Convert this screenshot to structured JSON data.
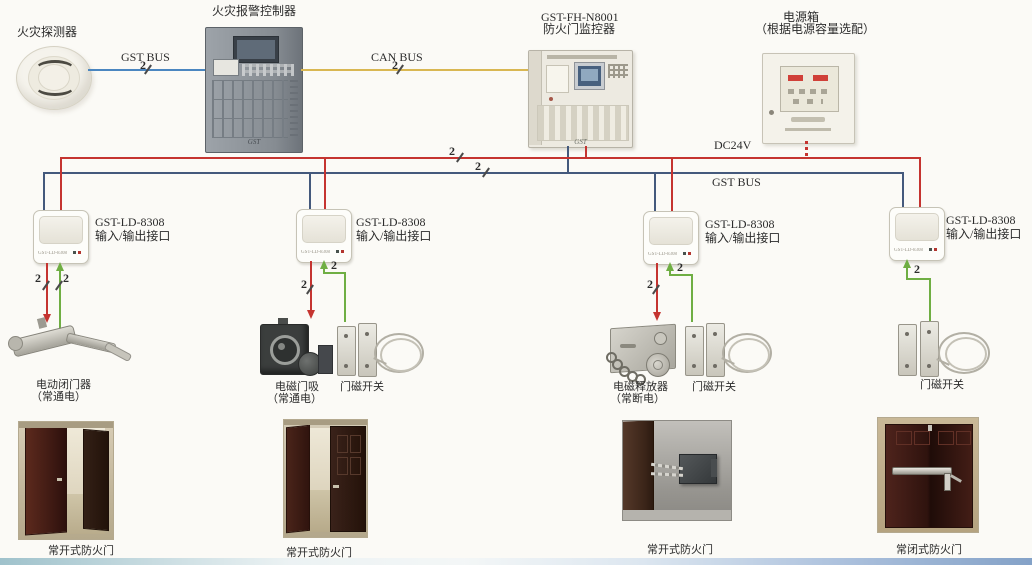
{
  "detector": {
    "label": "火灾探测器"
  },
  "controller": {
    "label": "火灾报警控制器",
    "logo": "GST"
  },
  "monitor": {
    "model": "GST-FH-N8001",
    "label": "防火门监控器",
    "logo": "GST"
  },
  "power_box": {
    "label": "电源箱",
    "note": "（根据电源容量选配）"
  },
  "wires": {
    "gst_bus_top": {
      "label": "GST BUS",
      "count": "2"
    },
    "can_bus": {
      "label": "CAN BUS",
      "count": "2"
    },
    "dc24v": {
      "label": "DC24V",
      "count": "2"
    },
    "gst_bus_main": {
      "label": "GST BUS",
      "count": "2"
    }
  },
  "modules": [
    {
      "model": "GST-LD-8308",
      "label": "输入/输出接口",
      "out_count": "2",
      "in_count": "2"
    },
    {
      "model": "GST-LD-8308",
      "label": "输入/输出接口",
      "out_count": "2",
      "in_count": "2"
    },
    {
      "model": "GST-LD-8308",
      "label": "输入/输出接口",
      "out_count": "2",
      "in_count": "2"
    },
    {
      "model": "GST-LD-8308",
      "label": "输入/输出接口",
      "in_count": "2"
    }
  ],
  "field_devices": {
    "door_closer": {
      "name": "电动闭门器",
      "note": "（常通电）"
    },
    "door_holder": {
      "name": "电磁门吸",
      "note": "（常通电）"
    },
    "door_switch1": {
      "name": "门磁开关"
    },
    "releaser": {
      "name": "电磁释放器",
      "note": "（常断电）"
    },
    "door_switch2": {
      "name": "门磁开关"
    },
    "door_switch3": {
      "name": "门磁开关"
    }
  },
  "doors": [
    {
      "caption": "常开式防火门"
    },
    {
      "caption": "常开式防火门"
    },
    {
      "caption": "常开式防火门"
    },
    {
      "caption": "常闭式防火门"
    }
  ],
  "colors": {
    "red_wire": "#c53430",
    "blue_bus": "#44597c",
    "blue_wire": "#4a86c0",
    "yellow_wire": "#d9b752",
    "green_wire": "#6fae43"
  }
}
